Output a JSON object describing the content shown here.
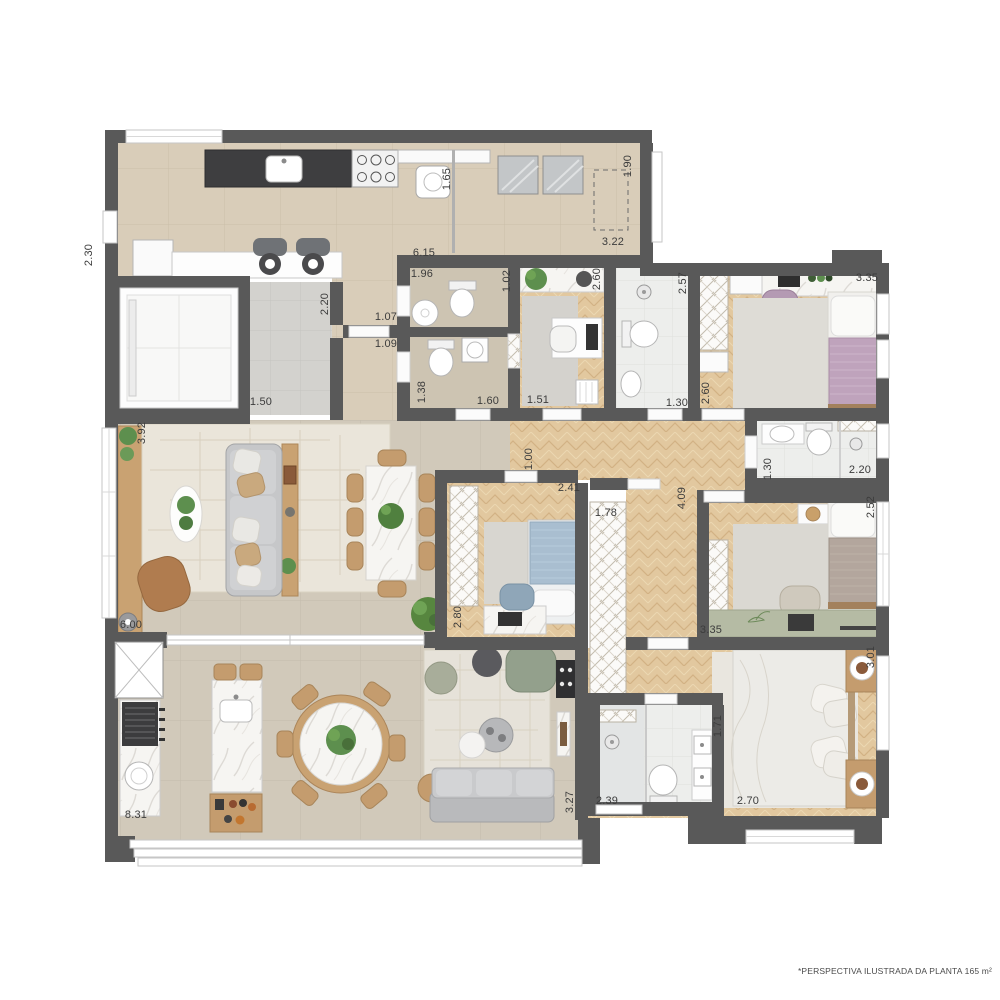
{
  "footer": {
    "note": "*PERSPECTIVA ILUSTRADA DA PLANTA 165 m²"
  },
  "palette": {
    "wall": "#595959",
    "floor_tile_beige": "#d9cdb9",
    "floor_living": "#d1c9ba",
    "floor_wood": "#e1c79f",
    "floor_bath": "#edeeec",
    "floor_taupe": "#cdc4b2",
    "marble": "#f6f5f2",
    "wood_furniture": "#c49c6e",
    "sofa_gray": "#c4c5c7",
    "bed_purple": "#bfa3bc",
    "bed_blue": "#a9bed0",
    "bed_taupe": "#b3a69d",
    "desk_green": "#b5bba4",
    "plant_green": "#5d8f4e",
    "label_color": "#3c3c3c"
  },
  "labels": [
    {
      "id": "kitchen-left-depth",
      "value": "2.30"
    },
    {
      "id": "kitchen-partition",
      "value": "1.65"
    },
    {
      "id": "kitchen-width",
      "value": "6.15"
    },
    {
      "id": "laundry-depth",
      "value": "1.90"
    },
    {
      "id": "laundry-width",
      "value": "3.22"
    },
    {
      "id": "elevator-hall-depth",
      "value": "2.20"
    },
    {
      "id": "entry-door-a",
      "value": "1.07"
    },
    {
      "id": "entry-door-b",
      "value": "1.09"
    },
    {
      "id": "elevator-hall-width",
      "value": "1.50"
    },
    {
      "id": "lavabo-width",
      "value": "1.96"
    },
    {
      "id": "lavabo-depth",
      "value": "1.02"
    },
    {
      "id": "office-depth",
      "value": "2.60"
    },
    {
      "id": "bath-office-depth",
      "value": "2.57"
    },
    {
      "id": "bath-social-depth",
      "value": "1.38"
    },
    {
      "id": "bath-social-width",
      "value": "1.60"
    },
    {
      "id": "office-width",
      "value": "1.51"
    },
    {
      "id": "bath-office-width",
      "value": "1.30"
    },
    {
      "id": "bedroom1-depth",
      "value": "2.60"
    },
    {
      "id": "bedroom1-width",
      "value": "3.35"
    },
    {
      "id": "bath-bedroom1-width",
      "value": "1.30"
    },
    {
      "id": "bath-bedroom1-depth",
      "value": "2.20"
    },
    {
      "id": "bedroom2-depth",
      "value": "2.52"
    },
    {
      "id": "corridor-length",
      "value": "4.09"
    },
    {
      "id": "living-left-depth",
      "value": "3.92"
    },
    {
      "id": "living-width",
      "value": "6.00"
    },
    {
      "id": "bedroom-mid-door",
      "value": "1.00"
    },
    {
      "id": "bedroom-mid-width",
      "value": "2.41"
    },
    {
      "id": "corridor-wardrobe",
      "value": "1.78"
    },
    {
      "id": "bedroom-mid-depth",
      "value": "2.80"
    },
    {
      "id": "bedroom2-width",
      "value": "3.35"
    },
    {
      "id": "master-depth",
      "value": "3.01"
    },
    {
      "id": "master-width",
      "value": "2.70"
    },
    {
      "id": "bath-master-depth",
      "value": "1.71"
    },
    {
      "id": "bath-master-width",
      "value": "2.39"
    },
    {
      "id": "tv-room-depth",
      "value": "3.27"
    },
    {
      "id": "terrace-width",
      "value": "8.31"
    }
  ]
}
